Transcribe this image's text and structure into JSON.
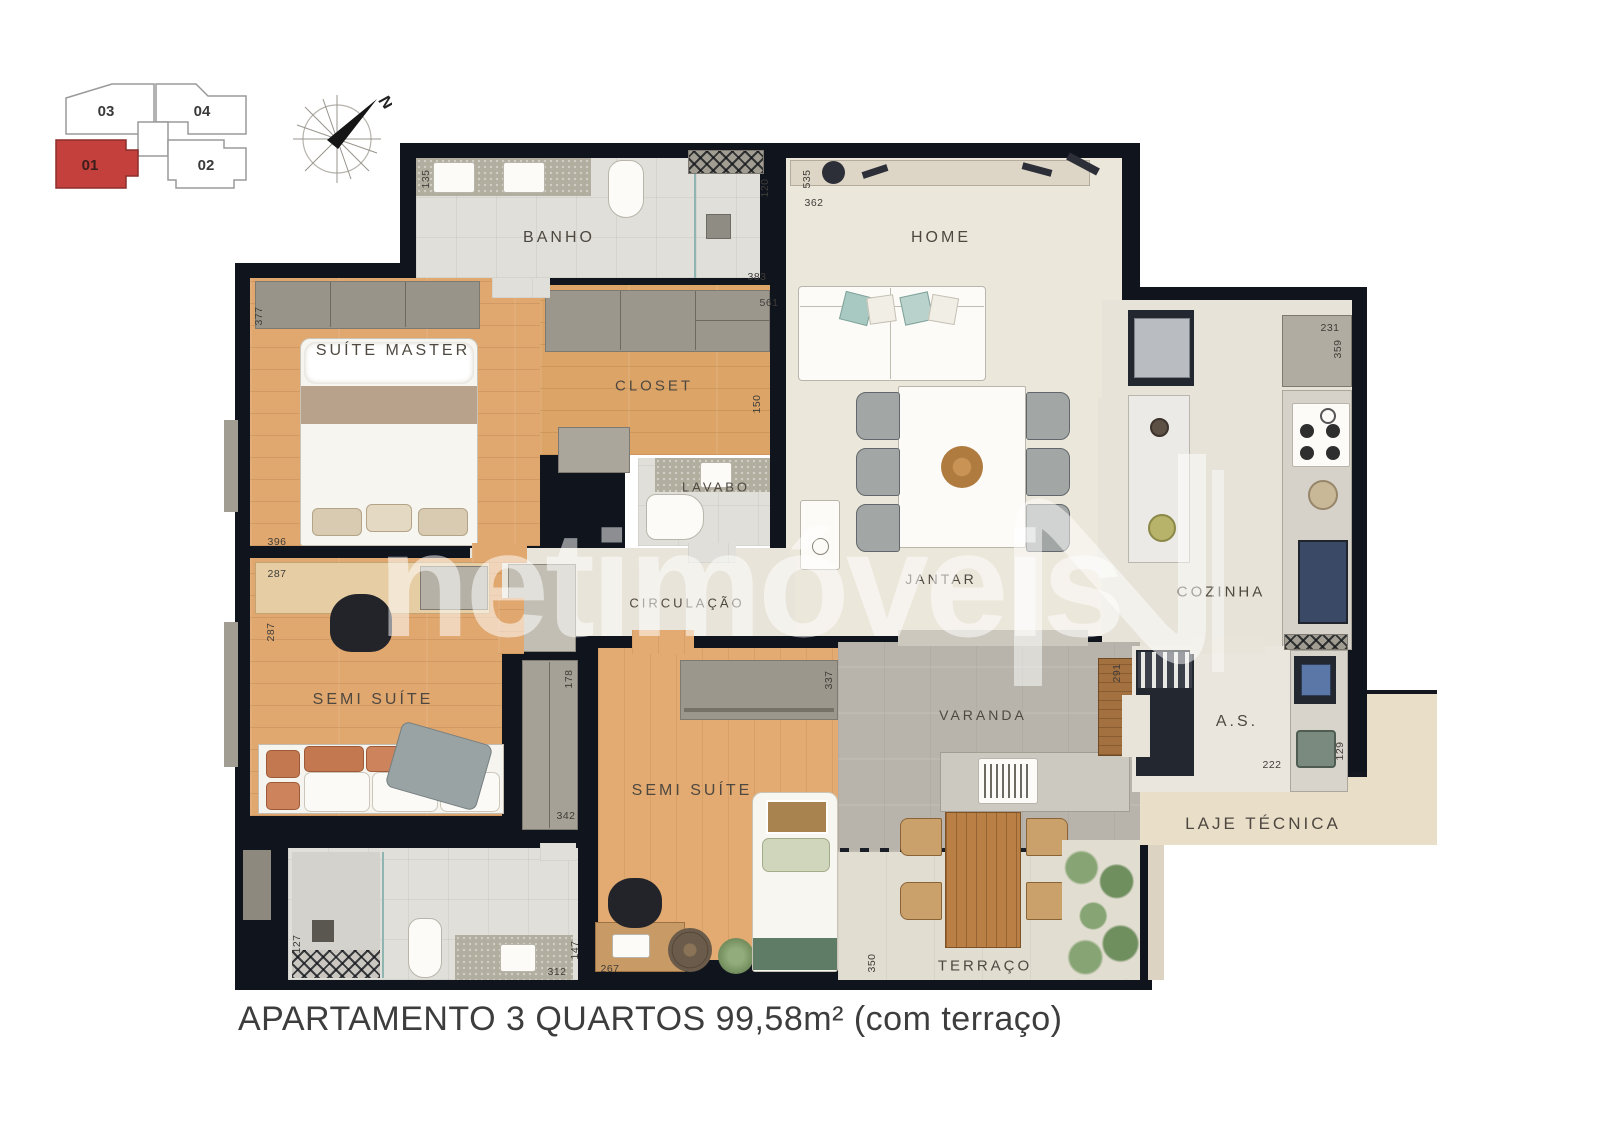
{
  "title_caption": "APARTAMENTO 3 QUARTOS 99,58m² (com terraço)",
  "watermark": {
    "brand": "netimóveis"
  },
  "key_plan": {
    "units": [
      {
        "id": "03",
        "highlighted": false
      },
      {
        "id": "04",
        "highlighted": false
      },
      {
        "id": "01",
        "highlighted": true
      },
      {
        "id": "02",
        "highlighted": false
      }
    ],
    "highlight_color": "#c4403c"
  },
  "compass": {
    "north_label": "N"
  },
  "floorplan": {
    "rooms": [
      {
        "slug": "banho-superior",
        "label": "BANHO",
        "x": 559,
        "y": 238,
        "fs": 16
      },
      {
        "slug": "home",
        "label": "HOME",
        "x": 941,
        "y": 238,
        "fs": 16
      },
      {
        "slug": "suite-master",
        "label": "SUÍTE MASTER",
        "x": 393,
        "y": 351,
        "fs": 16
      },
      {
        "slug": "closet",
        "label": "CLOSET",
        "x": 654,
        "y": 386,
        "fs": 15
      },
      {
        "slug": "lavabo",
        "label": "LAVABO",
        "x": 716,
        "y": 487,
        "fs": 13
      },
      {
        "slug": "jantar",
        "label": "JANTAR",
        "x": 941,
        "y": 579,
        "fs": 14
      },
      {
        "slug": "circulacao",
        "label": "CIRCULAÇÃO",
        "x": 687,
        "y": 603,
        "fs": 13
      },
      {
        "slug": "cozinha",
        "label": "COZINHA",
        "x": 1221,
        "y": 592,
        "fs": 15
      },
      {
        "slug": "semi-suite-1",
        "label": "SEMI SUÍTE",
        "x": 373,
        "y": 700,
        "fs": 16
      },
      {
        "slug": "semi-suite-2",
        "label": "SEMI SUÍTE",
        "x": 692,
        "y": 791,
        "fs": 16
      },
      {
        "slug": "varanda",
        "label": "VARANDA",
        "x": 983,
        "y": 715,
        "fs": 14
      },
      {
        "slug": "as",
        "label": "A.S.",
        "x": 1237,
        "y": 722,
        "fs": 16
      },
      {
        "slug": "terraco",
        "label": "TERRAÇO",
        "x": 985,
        "y": 966,
        "fs": 15
      },
      {
        "slug": "laje-tecnica",
        "label": "LAJE TÉCNICA",
        "x": 1263,
        "y": 824,
        "fs": 17
      }
    ],
    "dimensions": [
      {
        "label": "135",
        "x": 426,
        "y": 179,
        "v": true
      },
      {
        "label": "120",
        "x": 765,
        "y": 188,
        "v": true
      },
      {
        "label": "383",
        "x": 757,
        "y": 277,
        "v": false
      },
      {
        "label": "561",
        "x": 769,
        "y": 303,
        "v": false
      },
      {
        "label": "535",
        "x": 807,
        "y": 179,
        "v": true
      },
      {
        "label": "362",
        "x": 814,
        "y": 203,
        "v": false
      },
      {
        "label": "231",
        "x": 1330,
        "y": 328,
        "v": false
      },
      {
        "label": "359",
        "x": 1338,
        "y": 349,
        "v": true
      },
      {
        "label": "377",
        "x": 259,
        "y": 316,
        "v": true
      },
      {
        "label": "396",
        "x": 277,
        "y": 542,
        "v": false
      },
      {
        "label": "287",
        "x": 277,
        "y": 574,
        "v": false
      },
      {
        "label": "287",
        "x": 271,
        "y": 632,
        "v": true
      },
      {
        "label": "178",
        "x": 569,
        "y": 679,
        "v": true
      },
      {
        "label": "342",
        "x": 566,
        "y": 816,
        "v": false
      },
      {
        "label": "127",
        "x": 297,
        "y": 944,
        "v": true
      },
      {
        "label": "312",
        "x": 557,
        "y": 972,
        "v": false
      },
      {
        "label": "147",
        "x": 575,
        "y": 950,
        "v": true
      },
      {
        "label": "267",
        "x": 610,
        "y": 969,
        "v": false
      },
      {
        "label": "337",
        "x": 829,
        "y": 680,
        "v": true
      },
      {
        "label": "291",
        "x": 1117,
        "y": 673,
        "v": true
      },
      {
        "label": "350",
        "x": 872,
        "y": 963,
        "v": true
      },
      {
        "label": "222",
        "x": 1272,
        "y": 765,
        "v": false
      },
      {
        "label": "129",
        "x": 1340,
        "y": 751,
        "v": true
      },
      {
        "label": "150",
        "x": 757,
        "y": 404,
        "v": true
      }
    ]
  }
}
